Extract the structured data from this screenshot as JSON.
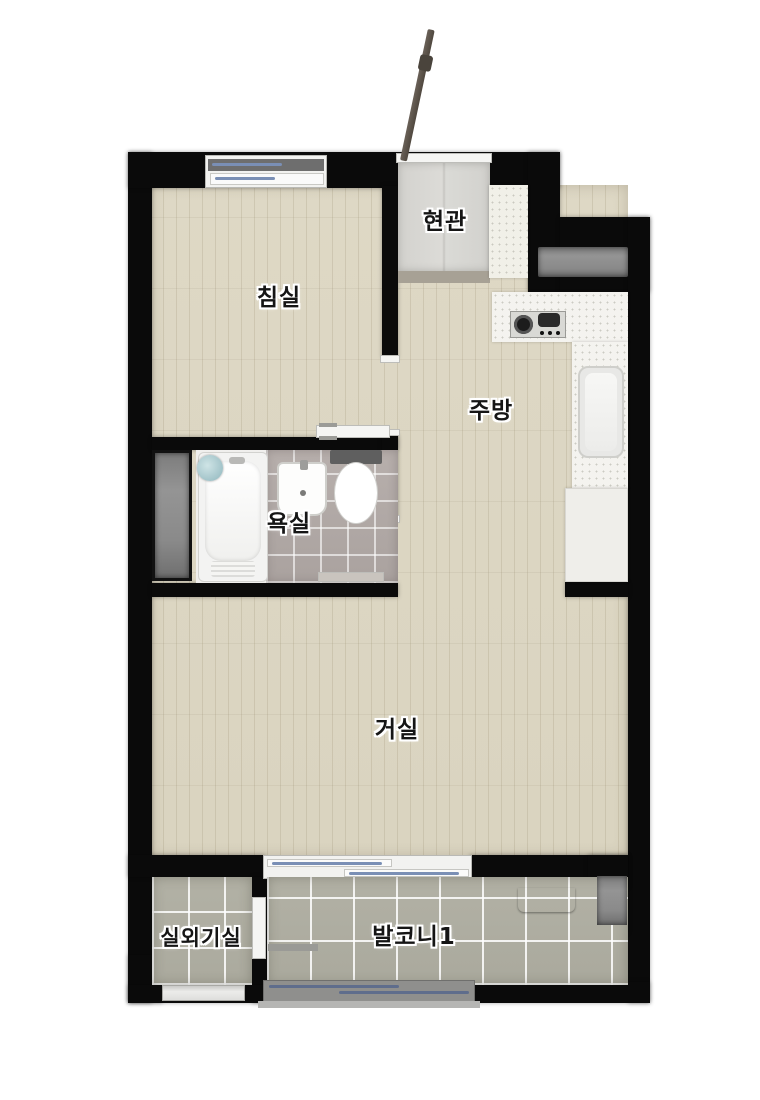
{
  "floorplan": {
    "rooms": {
      "bedroom": {
        "label": "침실"
      },
      "entrance": {
        "label": "현관"
      },
      "kitchen": {
        "label": "주방"
      },
      "bathroom": {
        "label": "욕실"
      },
      "living_room": {
        "label": "거실"
      },
      "outdoor_unit_room": {
        "label": "실외기실"
      },
      "balcony": {
        "label": "발코니1"
      }
    },
    "colors": {
      "wall": "#0a0a0a",
      "wood_floor": "#ded8c5",
      "entrance_tile": "#d6d5d2",
      "entrance_threshold": "#a7a195",
      "bathroom_tile": "#b7afac",
      "balcony_tile": "#b1b0a4",
      "counter_white": "#f4f3ef",
      "cabinet_white": "#efeeea",
      "duct_gray": "#8c8c8c",
      "glass_blue": "#7a8fb5",
      "door_brown": "#5b5349",
      "shelf_brown": "#8a7e6e"
    },
    "fixtures": [
      "entrance-door",
      "shoe-cabinet",
      "gas-stove",
      "kitchen-sink",
      "kitchen-cabinet",
      "bathtub",
      "shower-head",
      "bathroom-sink",
      "toilet",
      "sliding-door",
      "duct",
      "balcony-shelf",
      "window"
    ]
  }
}
